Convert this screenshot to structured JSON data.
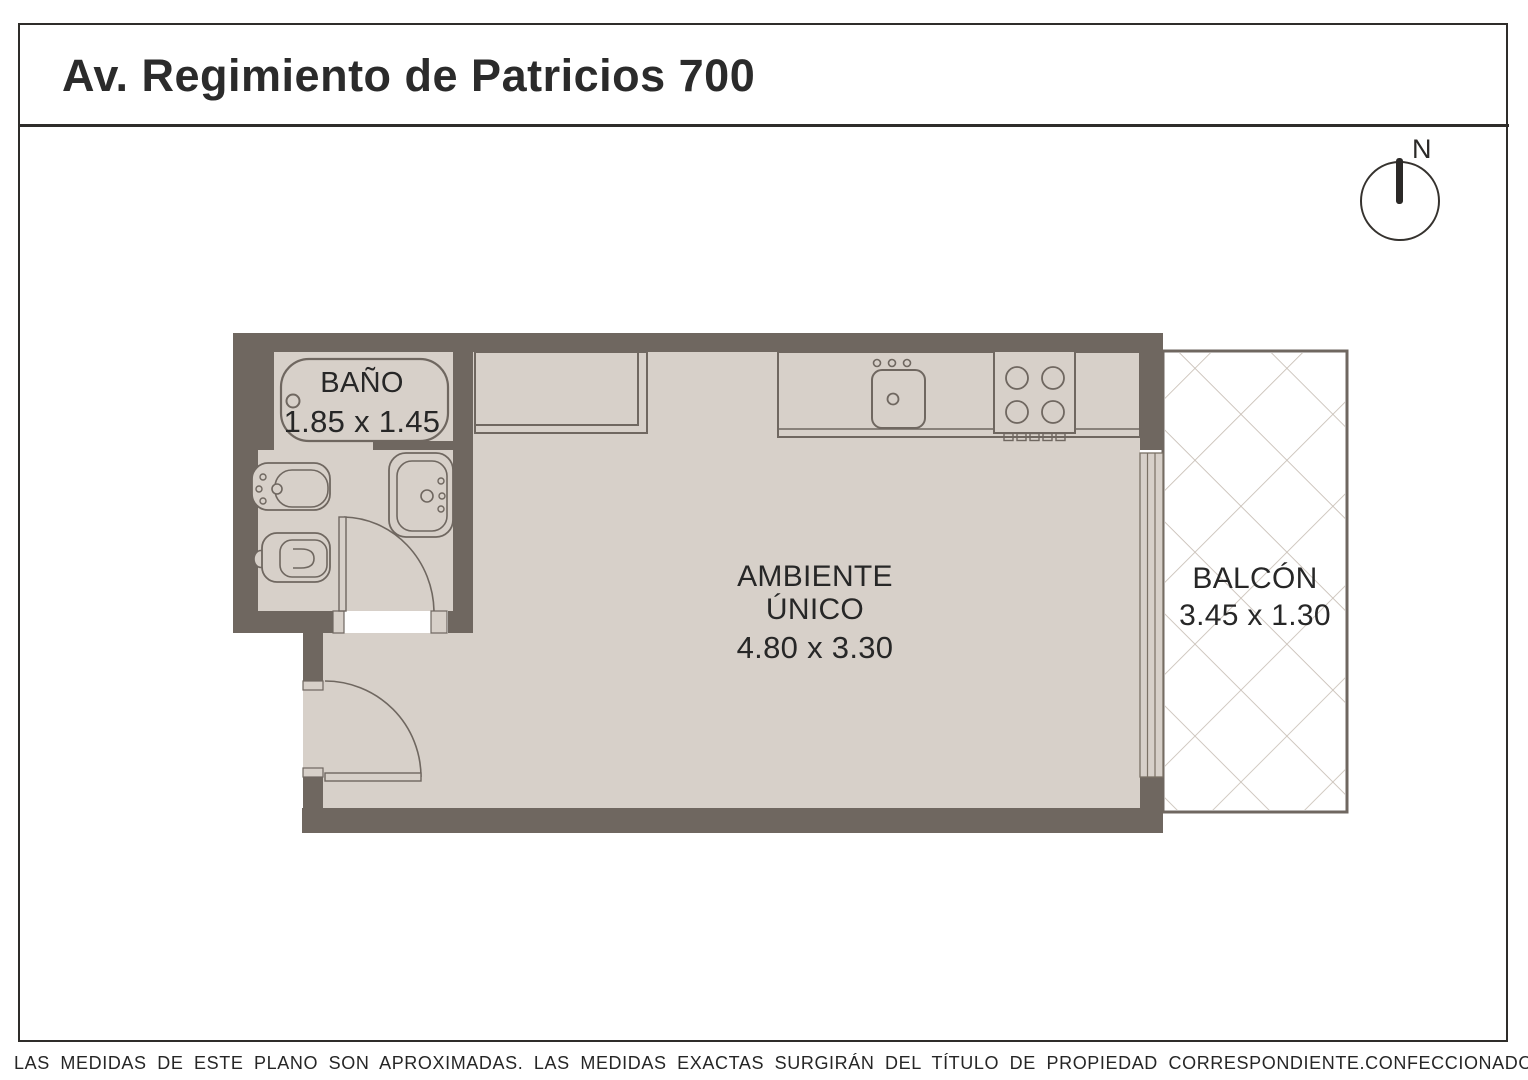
{
  "page": {
    "title": "Av. Regimiento de Patricios 700",
    "compass_north_label": "N"
  },
  "rooms": {
    "bathroom": {
      "name": "BAÑO",
      "dimensions": "1.85 x 1.45"
    },
    "main": {
      "name": "AMBIENTE ÚNICO",
      "dimensions": "4.80 x 3.30"
    },
    "balcony": {
      "name": "BALCÓN",
      "dimensions": "3.45 x 1.30"
    }
  },
  "fixtures": [
    "bathtub",
    "bidet",
    "toilet",
    "bathroom-sink",
    "kitchen-closet",
    "kitchen-counter",
    "kitchen-sink",
    "stove",
    "bathroom-door",
    "entry-door",
    "sliding-window",
    "balcony-hatch",
    "north-compass"
  ],
  "footer": {
    "disclaimer": "LAS MEDIDAS  DE ESTE PLANO SON APROXIMADAS. LAS MEDIDAS EXACTAS SURGIRÁN DEL TÍTULO DE PROPIEDAD CORRESPONDIENTE.",
    "credit": "CONFECCIONADO POR ESTUDIO NARTEX"
  },
  "colors": {
    "wall": "#6F6760",
    "floor": "#D7D0C9",
    "balcony_hatch": "#C9C0B7",
    "text": "#272727"
  }
}
